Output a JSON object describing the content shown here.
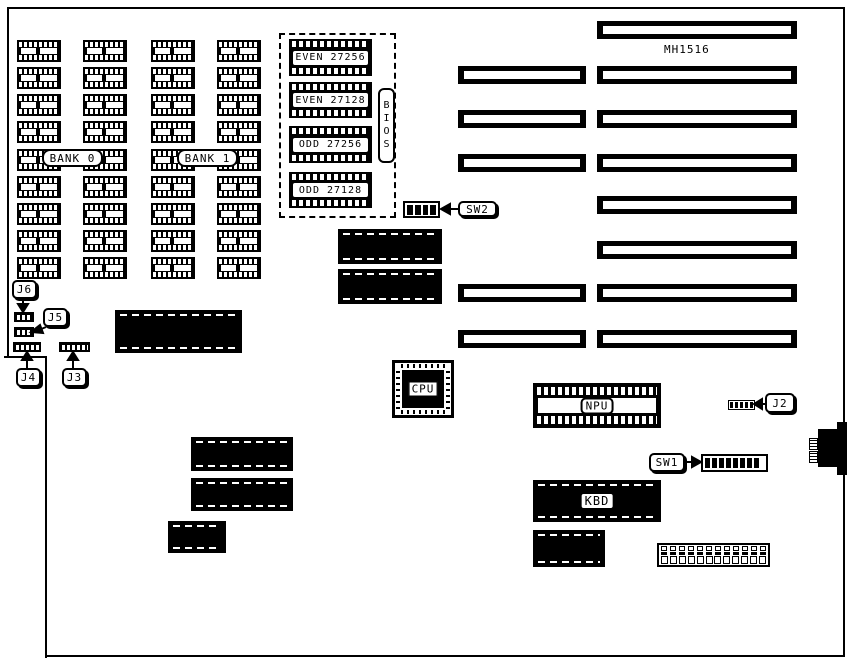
{
  "board": {
    "model": "MH1516"
  },
  "memory": {
    "bank0_label": "BANK 0",
    "bank1_label": "BANK 1",
    "grid": {
      "col_x": [
        17,
        83,
        151,
        217
      ],
      "row_y": [
        40,
        67,
        94,
        121,
        149,
        176,
        203,
        230,
        257
      ],
      "chip_w": 44,
      "chip_h": 22
    }
  },
  "bios": {
    "label": "BIOS",
    "chips": [
      {
        "label": "EVEN 27256",
        "y": 39,
        "h": 37
      },
      {
        "label": "EVEN 27128",
        "y": 82,
        "h": 36
      },
      {
        "label": "ODD 27256",
        "y": 126,
        "h": 37
      },
      {
        "label": "ODD 27128",
        "y": 172,
        "h": 36
      }
    ]
  },
  "slots": {
    "left": {
      "x": 458,
      "w": 128,
      "y": [
        66,
        110,
        154,
        284,
        330
      ]
    },
    "right": {
      "x": 597,
      "w": 200,
      "y": [
        21,
        66,
        110,
        154,
        196,
        241,
        284,
        330
      ]
    },
    "h": 18
  },
  "chips": [
    {
      "x": 338,
      "y": 229,
      "w": 104,
      "h": 35
    },
    {
      "x": 338,
      "y": 269,
      "w": 104,
      "h": 35
    },
    {
      "x": 115,
      "y": 310,
      "w": 127,
      "h": 43
    },
    {
      "x": 191,
      "y": 437,
      "w": 102,
      "h": 34
    },
    {
      "x": 191,
      "y": 478,
      "w": 102,
      "h": 33
    },
    {
      "x": 168,
      "y": 521,
      "w": 58,
      "h": 32
    },
    {
      "x": 533,
      "y": 480,
      "w": 128,
      "h": 42,
      "label": "KBD"
    },
    {
      "x": 533,
      "y": 530,
      "w": 72,
      "h": 37
    }
  ],
  "cpu": {
    "label": "CPU"
  },
  "npu": {
    "label": "NPU"
  },
  "switches": {
    "sw1": {
      "label": "SW1",
      "positions": 8
    },
    "sw2": {
      "label": "SW2",
      "positions": 4
    }
  },
  "jumpers": {
    "j2": {
      "label": "J2",
      "pins": 5
    },
    "j3": {
      "label": "J3",
      "pins": 6
    },
    "j4": {
      "label": "J4",
      "pins": 5
    },
    "j5": {
      "label": "J5",
      "pins": 3
    },
    "j6": {
      "label": "J6",
      "pins": 3
    }
  },
  "power_connector": {
    "positions": 12
  }
}
